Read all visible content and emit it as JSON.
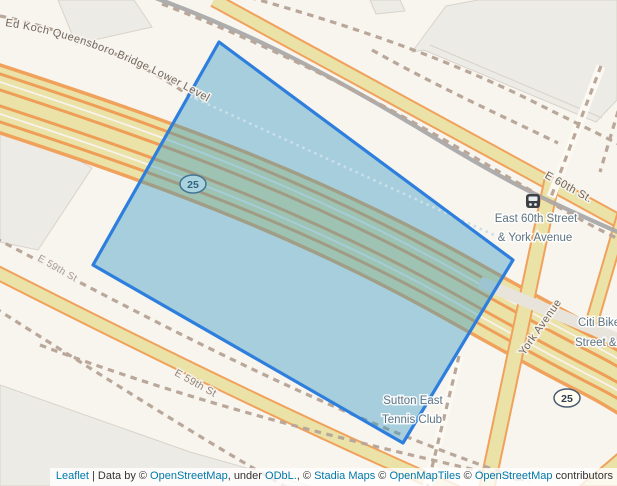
{
  "map": {
    "street_labels": {
      "bridge": "Ed Koch Queensboro Bridge Lower Level",
      "e60th": "E 60th St.",
      "e59th_upper": "E 59th St",
      "e59th_lower": "E 59th St",
      "york_avenue": "York Avenue"
    },
    "route_shield": "25",
    "poi_labels": {
      "bus_stop_line1": "East 60th Street",
      "bus_stop_line2": "& York Avenue",
      "citibike_line1": "Citi Bike",
      "citibike_line2": "Street &",
      "tennis_line1": "Sutton East",
      "tennis_line2": "Tennis Club"
    },
    "colors": {
      "background": "#f8f4ee",
      "road_fill": "#ebe2a8",
      "road_casing": "#f0a25c",
      "building": "#edebe6",
      "railway_dash": "#b9a79a",
      "railway_gray": "#a9a9a9",
      "polygon_stroke": "#2e7fdd",
      "polygon_fill": "rgba(52,152,195,0.42)",
      "poi_label": "#5d7382",
      "link": "#0078a8"
    }
  },
  "attribution": {
    "leaflet": "Leaflet",
    "sep": " | Data by © ",
    "osm1": "OpenStreetMap",
    "mid1": ", under ",
    "odbl": "ODbL.",
    "mid2": ", © ",
    "stadia": "Stadia Maps",
    "mid3": " © ",
    "openmaptiles": "OpenMapTiles",
    "mid4": " © ",
    "osm2": "OpenStreetMap",
    "suffix": " contributors"
  }
}
